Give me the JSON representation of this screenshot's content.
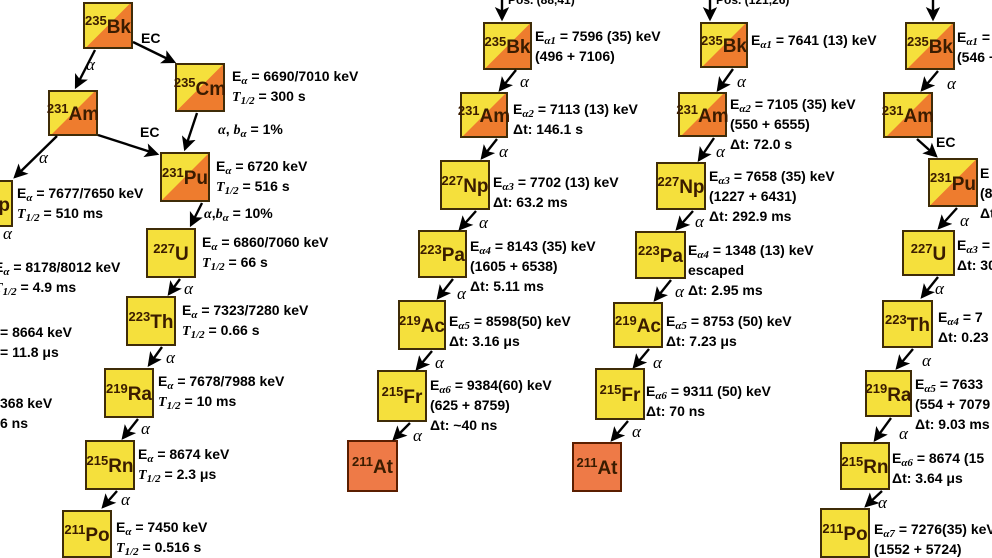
{
  "palette": {
    "yellow": "#f5e03c",
    "orange_split": "#ee7c2e",
    "orange_at": "#ee7a47",
    "border": "#3f2c08",
    "border_at": "#5b1e00",
    "text": "#000000",
    "nuclide_text": "#3a1c00"
  },
  "boxes": [
    {
      "name": "nuclide-235bk-c1",
      "mass": "235",
      "sym": "Bk",
      "x": 83,
      "y": 2,
      "w": 50,
      "h": 47,
      "fill": "split"
    },
    {
      "name": "nuclide-235cm-c1",
      "mass": "235",
      "sym": "Cm",
      "x": 175,
      "y": 63,
      "w": 50,
      "h": 49,
      "fill": "split"
    },
    {
      "name": "nuclide-231am-c1",
      "mass": "231",
      "sym": "Am",
      "x": 48,
      "y": 90,
      "w": 50,
      "h": 46,
      "fill": "split"
    },
    {
      "name": "nuclide-231pu-c1",
      "mass": "231",
      "sym": "Pu",
      "x": 160,
      "y": 152,
      "w": 50,
      "h": 50,
      "fill": "split"
    },
    {
      "name": "nuclide-227u-c1",
      "mass": "227",
      "sym": "U",
      "x": 146,
      "y": 228,
      "w": 50,
      "h": 50,
      "fill": "yellow"
    },
    {
      "name": "nuclide-223th-c1",
      "mass": "223",
      "sym": "Th",
      "x": 126,
      "y": 296,
      "w": 50,
      "h": 50,
      "fill": "yellow"
    },
    {
      "name": "nuclide-219ra-c1",
      "mass": "219",
      "sym": "Ra",
      "x": 104,
      "y": 368,
      "w": 50,
      "h": 50,
      "fill": "yellow"
    },
    {
      "name": "nuclide-215rn-c1",
      "mass": "215",
      "sym": "Rn",
      "x": 85,
      "y": 440,
      "w": 50,
      "h": 50,
      "fill": "yellow"
    },
    {
      "name": "nuclide-211po-c1",
      "mass": "211",
      "sym": "Po",
      "x": 62,
      "y": 510,
      "w": 50,
      "h": 48,
      "fill": "yellow"
    },
    {
      "name": "nuclide-227np-left-partial",
      "mass": "227",
      "sym": "Np",
      "x": -40,
      "y": 180,
      "w": 53,
      "h": 47,
      "fill": "yellow"
    },
    {
      "name": "nuclide-235bk-c2",
      "mass": "235",
      "sym": "Bk",
      "x": 483,
      "y": 22,
      "w": 49,
      "h": 48,
      "fill": "split"
    },
    {
      "name": "nuclide-231am-c2",
      "mass": "231",
      "sym": "Am",
      "x": 460,
      "y": 92,
      "w": 48,
      "h": 46,
      "fill": "split"
    },
    {
      "name": "nuclide-227np-c2",
      "mass": "227",
      "sym": "Np",
      "x": 440,
      "y": 160,
      "w": 50,
      "h": 50,
      "fill": "yellow"
    },
    {
      "name": "nuclide-223pa-c2",
      "mass": "223",
      "sym": "Pa",
      "x": 418,
      "y": 230,
      "w": 49,
      "h": 48,
      "fill": "yellow"
    },
    {
      "name": "nuclide-219ac-c2",
      "mass": "219",
      "sym": "Ac",
      "x": 398,
      "y": 300,
      "w": 48,
      "h": 50,
      "fill": "yellow"
    },
    {
      "name": "nuclide-215fr-c2",
      "mass": "215",
      "sym": "Fr",
      "x": 377,
      "y": 370,
      "w": 50,
      "h": 52,
      "fill": "yellow"
    },
    {
      "name": "nuclide-211at-c2",
      "mass": "211",
      "sym": "At",
      "x": 347,
      "y": 440,
      "w": 51,
      "h": 52,
      "fill": "orange"
    },
    {
      "name": "nuclide-235bk-c3",
      "mass": "235",
      "sym": "Bk",
      "x": 700,
      "y": 22,
      "w": 48,
      "h": 46,
      "fill": "split"
    },
    {
      "name": "nuclide-231am-c3",
      "mass": "231",
      "sym": "Am",
      "x": 678,
      "y": 92,
      "w": 49,
      "h": 45,
      "fill": "split"
    },
    {
      "name": "nuclide-227np-c3",
      "mass": "227",
      "sym": "Np",
      "x": 656,
      "y": 162,
      "w": 50,
      "h": 48,
      "fill": "yellow"
    },
    {
      "name": "nuclide-223pa-c3",
      "mass": "223",
      "sym": "Pa",
      "x": 635,
      "y": 231,
      "w": 51,
      "h": 48,
      "fill": "yellow"
    },
    {
      "name": "nuclide-219ac-c3",
      "mass": "219",
      "sym": "Ac",
      "x": 613,
      "y": 302,
      "w": 50,
      "h": 46,
      "fill": "yellow"
    },
    {
      "name": "nuclide-215fr-c3",
      "mass": "215",
      "sym": "Fr",
      "x": 595,
      "y": 368,
      "w": 50,
      "h": 52,
      "fill": "yellow"
    },
    {
      "name": "nuclide-211at-c3",
      "mass": "211",
      "sym": "At",
      "x": 572,
      "y": 442,
      "w": 50,
      "h": 50,
      "fill": "orange"
    },
    {
      "name": "nuclide-235bk-c4",
      "mass": "235",
      "sym": "Bk",
      "x": 905,
      "y": 22,
      "w": 50,
      "h": 48,
      "fill": "split"
    },
    {
      "name": "nuclide-231am-c4",
      "mass": "231",
      "sym": "Am",
      "x": 883,
      "y": 92,
      "w": 50,
      "h": 46,
      "fill": "split"
    },
    {
      "name": "nuclide-231pu-c4",
      "mass": "231",
      "sym": "Pu",
      "x": 928,
      "y": 158,
      "w": 50,
      "h": 49,
      "fill": "split"
    },
    {
      "name": "nuclide-227u-c4",
      "mass": "227",
      "sym": "U",
      "x": 902,
      "y": 230,
      "w": 53,
      "h": 46,
      "fill": "yellow"
    },
    {
      "name": "nuclide-223th-c4",
      "mass": "223",
      "sym": "Th",
      "x": 882,
      "y": 300,
      "w": 51,
      "h": 48,
      "fill": "yellow"
    },
    {
      "name": "nuclide-219ra-c4",
      "mass": "219",
      "sym": "Ra",
      "x": 865,
      "y": 370,
      "w": 47,
      "h": 47,
      "fill": "yellow"
    },
    {
      "name": "nuclide-215rn-c4",
      "mass": "215",
      "sym": "Rn",
      "x": 840,
      "y": 442,
      "w": 50,
      "h": 48,
      "fill": "yellow"
    },
    {
      "name": "nuclide-211po-c4",
      "mass": "211",
      "sym": "Po",
      "x": 820,
      "y": 508,
      "w": 50,
      "h": 50,
      "fill": "yellow"
    }
  ],
  "texts": [
    {
      "name": "label-235cm-c1",
      "x": 232,
      "y": 66,
      "lines": [
        "E_{α} = 6690/7010 keV",
        "*T*_{1/2} = 300 s"
      ]
    },
    {
      "name": "label-231pu-c1",
      "x": 216,
      "y": 156,
      "lines": [
        "E_{α} = 6720 keV",
        "*T*_{1/2} = 516 s"
      ]
    },
    {
      "name": "label-227u-c1",
      "x": 202,
      "y": 232,
      "lines": [
        "E_{α} = 6860/7060 keV",
        "*T*_{1/2} = 66 s"
      ]
    },
    {
      "name": "label-223th-c1",
      "x": 182,
      "y": 300,
      "lines": [
        "E_{α} = 7323/7280 keV",
        "*T*_{1/2} = 0.66 s"
      ]
    },
    {
      "name": "label-219ra-c1",
      "x": 158,
      "y": 371,
      "lines": [
        "E_{α} = 7678/7988 keV",
        "*T*_{1/2} = 10 ms"
      ]
    },
    {
      "name": "label-215rn-c1",
      "x": 138,
      "y": 444,
      "lines": [
        "E_{α} = 8674 keV",
        "*T*_{1/2} = 2.3 μs"
      ]
    },
    {
      "name": "label-211po-c1",
      "x": 116,
      "y": 517,
      "lines": [
        "E_{α} = 7450 keV",
        "*T*_{1/2} = 0.516 s"
      ]
    },
    {
      "name": "label-227np-left",
      "x": 17,
      "y": 183,
      "lines": [
        "E_{α} = 7677/7650 keV",
        "*T*_{1/2} = 510 ms"
      ]
    },
    {
      "name": "label-223pa-left-partial",
      "x": -6,
      "y": 257,
      "lines": [
        "E_{α} = 8178/8012 keV",
        "*T*_{1/2} = 4.9 ms"
      ]
    },
    {
      "name": "label-219ac-left-partial",
      "x": 0,
      "y": 322,
      "lines": [
        "= 8664 keV",
        "= 11.8 μs"
      ]
    },
    {
      "name": "label-215fr-left-partial",
      "x": 0,
      "y": 393,
      "lines": [
        "368 keV",
        "6 ns"
      ]
    },
    {
      "name": "label-235bk-c2",
      "x": 535,
      "y": 26,
      "lines": [
        "E_{α1} = 7596 (35) keV",
        "(496 + 7106)"
      ]
    },
    {
      "name": "label-231am-c2",
      "x": 513,
      "y": 99,
      "lines": [
        "E_{α2} = 7113 (13) keV",
        "Δt: 146.1 s"
      ]
    },
    {
      "name": "label-227np-c2",
      "x": 493,
      "y": 172,
      "lines": [
        "E_{α3} = 7702 (13) keV",
        "Δt: 63.2 ms"
      ]
    },
    {
      "name": "label-223pa-c2",
      "x": 470,
      "y": 236,
      "lines": [
        "E_{α4} = 8143 (35) keV",
        "(1605 + 6538)",
        "Δt: 5.11 ms"
      ]
    },
    {
      "name": "label-219ac-c2",
      "x": 449,
      "y": 311,
      "lines": [
        "E_{α5} = 8598(50) keV",
        "Δt: 3.16 μs"
      ]
    },
    {
      "name": "label-215fr-c2",
      "x": 430,
      "y": 375,
      "lines": [
        "E_{α6} = 9384(60) keV",
        "(625 + 8759)",
        "Δt: ~40 ns"
      ]
    },
    {
      "name": "label-235bk-c3",
      "x": 751,
      "y": 30,
      "lines": [
        "E_{α1} = 7641 (13) keV"
      ]
    },
    {
      "name": "label-231am-c3",
      "x": 730,
      "y": 94,
      "lines": [
        "E_{α2} = 7105 (35) keV",
        "(550 + 6555)",
        "Δt: 72.0 s"
      ]
    },
    {
      "name": "label-227np-c3",
      "x": 709,
      "y": 166,
      "lines": [
        "E_{α3} = 7658 (35) keV",
        "(1227 + 6431)",
        "Δt: 292.9 ms"
      ]
    },
    {
      "name": "label-223pa-c3",
      "x": 688,
      "y": 240,
      "lines": [
        "E_{α4} = 1348 (13) keV",
        "escaped",
        "Δt: 2.95 ms"
      ]
    },
    {
      "name": "label-219ac-c3",
      "x": 666,
      "y": 311,
      "lines": [
        "E_{α5} = 8753 (50) keV",
        "Δt: 7.23 μs"
      ]
    },
    {
      "name": "label-215fr-c3",
      "x": 646,
      "y": 381,
      "lines": [
        "E_{α6} = 9311 (50) keV",
        "Δt: 70 ns"
      ]
    },
    {
      "name": "label-235bk-c4-partial",
      "x": 957,
      "y": 27,
      "lines": [
        "E_{α1} =",
        "(546 +"
      ]
    },
    {
      "name": "label-231pu-c4-partial",
      "x": 980,
      "y": 163,
      "lines": [
        "E",
        "(8",
        "Δt"
      ]
    },
    {
      "name": "label-227u-c4-partial",
      "x": 957,
      "y": 235,
      "lines": [
        "E_{α3} =",
        "Δt: 30"
      ]
    },
    {
      "name": "label-223th-c4-partial",
      "x": 938,
      "y": 307,
      "lines": [
        "E_{α4} = 7",
        "Δt: 0.23"
      ]
    },
    {
      "name": "label-219ra-c4-partial",
      "x": 915,
      "y": 374,
      "lines": [
        "E_{α5} = 7633",
        "(554 + 7079",
        "Δt: 9.03 ms"
      ]
    },
    {
      "name": "label-215rn-c4-partial",
      "x": 892,
      "y": 448,
      "lines": [
        "E_{α6} = 8674 (15",
        "Δt: 3.64 μs"
      ]
    },
    {
      "name": "label-211po-c4-partial",
      "x": 874,
      "y": 519,
      "lines": [
        "E_{α7} = 7276(35) keV",
        "(1552 + 5724)"
      ]
    }
  ],
  "decay_labels": [
    {
      "name": "ec-label-bk-cm-c1",
      "t": "EC",
      "k": "ec",
      "x": 141,
      "y": 30
    },
    {
      "name": "alpha-label-bk-am-c1",
      "t": "α",
      "k": "alpha",
      "x": 86,
      "y": 55
    },
    {
      "name": "alpha-label-am-np-c1",
      "t": "α",
      "k": "alpha",
      "x": 39,
      "y": 148
    },
    {
      "name": "ec-label-am-pu-c1",
      "t": "EC",
      "k": "ec",
      "x": 140,
      "y": 124
    },
    {
      "name": "branch-label-cm-pu-c1",
      "t": "*α*, *b*_{α} = 1%",
      "k": "branch",
      "x": 218,
      "y": 121
    },
    {
      "name": "branch-label-pu-u-c1",
      "t": "*α*,*b*_{α} = 10%",
      "k": "branch",
      "x": 204,
      "y": 205
    },
    {
      "name": "alpha-label-np-left",
      "t": "α",
      "k": "alpha",
      "x": 3,
      "y": 224
    },
    {
      "name": "alpha-label-u-th-c1",
      "t": "α",
      "k": "alpha",
      "x": 184,
      "y": 279
    },
    {
      "name": "alpha-label-th-ra-c1",
      "t": "α",
      "k": "alpha",
      "x": 166,
      "y": 348
    },
    {
      "name": "alpha-label-ra-rn-c1",
      "t": "α",
      "k": "alpha",
      "x": 141,
      "y": 419
    },
    {
      "name": "alpha-label-rn-po-c1",
      "t": "α",
      "k": "alpha",
      "x": 121,
      "y": 490
    },
    {
      "name": "fragment-pos-c2",
      "t": "Pos. (88,41)",
      "k": "frag",
      "x": 508,
      "y": -7
    },
    {
      "name": "alpha-label-1-c2",
      "t": "α",
      "k": "alpha",
      "x": 520,
      "y": 72
    },
    {
      "name": "alpha-label-2-c2",
      "t": "α",
      "k": "alpha",
      "x": 499,
      "y": 142
    },
    {
      "name": "alpha-label-3-c2",
      "t": "α",
      "k": "alpha",
      "x": 479,
      "y": 213
    },
    {
      "name": "alpha-label-4-c2",
      "t": "α",
      "k": "alpha",
      "x": 457,
      "y": 284
    },
    {
      "name": "alpha-label-5-c2",
      "t": "α",
      "k": "alpha",
      "x": 435,
      "y": 353
    },
    {
      "name": "alpha-label-6-c2",
      "t": "α",
      "k": "alpha",
      "x": 413,
      "y": 426
    },
    {
      "name": "fragment-pos-c3",
      "t": "Pos. (121,26)",
      "k": "frag",
      "x": 716,
      "y": -7
    },
    {
      "name": "alpha-label-1-c3",
      "t": "α",
      "k": "alpha",
      "x": 737,
      "y": 72
    },
    {
      "name": "alpha-label-2-c3",
      "t": "α",
      "k": "alpha",
      "x": 716,
      "y": 142
    },
    {
      "name": "alpha-label-3-c3",
      "t": "α",
      "k": "alpha",
      "x": 695,
      "y": 212
    },
    {
      "name": "alpha-label-4-c3",
      "t": "α",
      "k": "alpha",
      "x": 675,
      "y": 282
    },
    {
      "name": "alpha-label-5-c3",
      "t": "α",
      "k": "alpha",
      "x": 653,
      "y": 353
    },
    {
      "name": "alpha-label-6-c3",
      "t": "α",
      "k": "alpha",
      "x": 632,
      "y": 422
    },
    {
      "name": "alpha-label-1-c4",
      "t": "α",
      "k": "alpha",
      "x": 947,
      "y": 74
    },
    {
      "name": "ec-label-am-pu-c4",
      "t": "EC",
      "k": "ec",
      "x": 936,
      "y": 134
    },
    {
      "name": "alpha-label-pu-u-c4",
      "t": "α",
      "k": "alpha",
      "x": 960,
      "y": 211
    },
    {
      "name": "alpha-label-u-th-c4",
      "t": "α",
      "k": "alpha",
      "x": 935,
      "y": 279
    },
    {
      "name": "alpha-label-th-ra-c4",
      "t": "α",
      "k": "alpha",
      "x": 922,
      "y": 351
    },
    {
      "name": "alpha-label-ra-rn-c4",
      "t": "α",
      "k": "alpha",
      "x": 899,
      "y": 424
    },
    {
      "name": "alpha-label-rn-po-c4",
      "t": "α",
      "k": "alpha",
      "x": 878,
      "y": 493
    }
  ],
  "arrows": [
    {
      "name": "arrow-bk-am-c1",
      "x1": 95,
      "y1": 50,
      "x2": 76,
      "y2": 87
    },
    {
      "name": "arrow-bk-cm-c1",
      "x1": 133,
      "y1": 42,
      "x2": 174,
      "y2": 62
    },
    {
      "name": "arrow-am-np-c1",
      "x1": 57,
      "y1": 136,
      "x2": 15,
      "y2": 177
    },
    {
      "name": "arrow-am-pu-c1",
      "x1": 98,
      "y1": 135,
      "x2": 157,
      "y2": 154
    },
    {
      "name": "arrow-cm-pu-c1",
      "x1": 197,
      "y1": 113,
      "x2": 185,
      "y2": 149
    },
    {
      "name": "arrow-pu-u-c1",
      "x1": 202,
      "y1": 203,
      "x2": 191,
      "y2": 225
    },
    {
      "name": "arrow-u-th-c1",
      "x1": 180,
      "y1": 279,
      "x2": 169,
      "y2": 294
    },
    {
      "name": "arrow-th-ra-c1",
      "x1": 162,
      "y1": 347,
      "x2": 149,
      "y2": 365
    },
    {
      "name": "arrow-ra-rn-c1",
      "x1": 138,
      "y1": 419,
      "x2": 123,
      "y2": 438
    },
    {
      "name": "arrow-rn-po-c1",
      "x1": 117,
      "y1": 491,
      "x2": 103,
      "y2": 507
    },
    {
      "name": "arrow-top-c2",
      "x1": 502,
      "y1": 0,
      "x2": 502,
      "y2": 19
    },
    {
      "name": "arrow-bk-am-c2",
      "x1": 516,
      "y1": 70,
      "x2": 500,
      "y2": 90
    },
    {
      "name": "arrow-am-np-c2",
      "x1": 497,
      "y1": 139,
      "x2": 482,
      "y2": 158
    },
    {
      "name": "arrow-np-pa-c2",
      "x1": 476,
      "y1": 211,
      "x2": 460,
      "y2": 229
    },
    {
      "name": "arrow-pa-ac-c2",
      "x1": 453,
      "y1": 279,
      "x2": 438,
      "y2": 298
    },
    {
      "name": "arrow-ac-fr-c2",
      "x1": 432,
      "y1": 351,
      "x2": 417,
      "y2": 369
    },
    {
      "name": "arrow-fr-at-c2",
      "x1": 410,
      "y1": 423,
      "x2": 394,
      "y2": 439
    },
    {
      "name": "arrow-top-c3",
      "x1": 710,
      "y1": 0,
      "x2": 710,
      "y2": 19
    },
    {
      "name": "arrow-bk-am-c3",
      "x1": 733,
      "y1": 69,
      "x2": 718,
      "y2": 90
    },
    {
      "name": "arrow-am-np-c3",
      "x1": 714,
      "y1": 138,
      "x2": 699,
      "y2": 160
    },
    {
      "name": "arrow-np-pa-c3",
      "x1": 693,
      "y1": 211,
      "x2": 677,
      "y2": 229
    },
    {
      "name": "arrow-pa-ac-c3",
      "x1": 671,
      "y1": 280,
      "x2": 655,
      "y2": 300
    },
    {
      "name": "arrow-ac-fr-c3",
      "x1": 649,
      "y1": 349,
      "x2": 634,
      "y2": 367
    },
    {
      "name": "arrow-fr-at-c3",
      "x1": 628,
      "y1": 421,
      "x2": 612,
      "y2": 440
    },
    {
      "name": "arrow-top-c4",
      "x1": 933,
      "y1": 0,
      "x2": 933,
      "y2": 19
    },
    {
      "name": "arrow-bk-am-c4",
      "x1": 938,
      "y1": 71,
      "x2": 922,
      "y2": 90
    },
    {
      "name": "arrow-am-pu-c4",
      "x1": 917,
      "y1": 139,
      "x2": 936,
      "y2": 156
    },
    {
      "name": "arrow-pu-u-c4",
      "x1": 957,
      "y1": 208,
      "x2": 939,
      "y2": 228
    },
    {
      "name": "arrow-u-th-c4",
      "x1": 938,
      "y1": 277,
      "x2": 922,
      "y2": 297
    },
    {
      "name": "arrow-th-ra-c4",
      "x1": 913,
      "y1": 349,
      "x2": 897,
      "y2": 368
    },
    {
      "name": "arrow-ra-rn-c4",
      "x1": 891,
      "y1": 418,
      "x2": 875,
      "y2": 440
    },
    {
      "name": "arrow-rn-po-c4",
      "x1": 882,
      "y1": 491,
      "x2": 866,
      "y2": 506
    }
  ]
}
